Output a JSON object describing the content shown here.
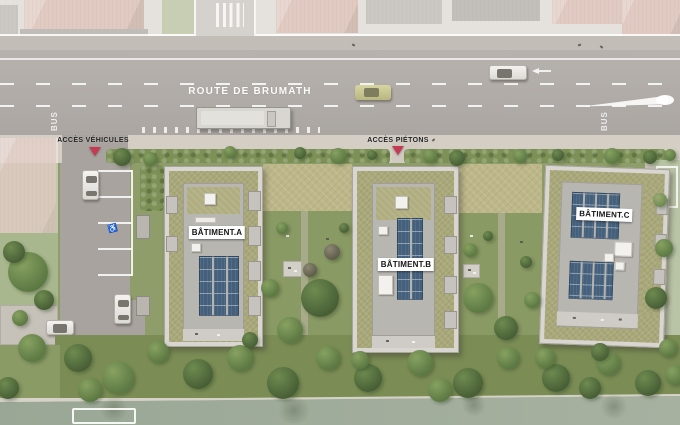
{
  "road": {
    "name": "ROUTE DE BRUMATH",
    "bus_left": "BUS",
    "bus_right": "BUS"
  },
  "access": {
    "vehicles": "ACCÈS VÉHICULES",
    "pedestrians": "ACCÈS PIÉTONS"
  },
  "buildings": [
    {
      "label": "BÂTIMENT.A"
    },
    {
      "label": "BÂTIMENT.B"
    },
    {
      "label": "BÂTIMENT.C"
    }
  ],
  "parking": {
    "accessible_symbol": "♿"
  },
  "colors": {
    "road": "#aba6a2",
    "shoulder": "#c3bdb7",
    "sidewalk": "#d4cec5",
    "site_green": "#8f9d6a",
    "garden_green": "#8a9a64",
    "meadow": "#bcb688",
    "green_roof": "#a9a87a",
    "roof_deck": "#b8b6b1",
    "walkway": "#d9d6d1",
    "solar_panel": "#44607c",
    "water": "#a7b1a0",
    "accent_arrow": "#c43a52",
    "existing_roof": "#cda093",
    "label_bg": "#ffffff",
    "label_text": "#141414"
  }
}
